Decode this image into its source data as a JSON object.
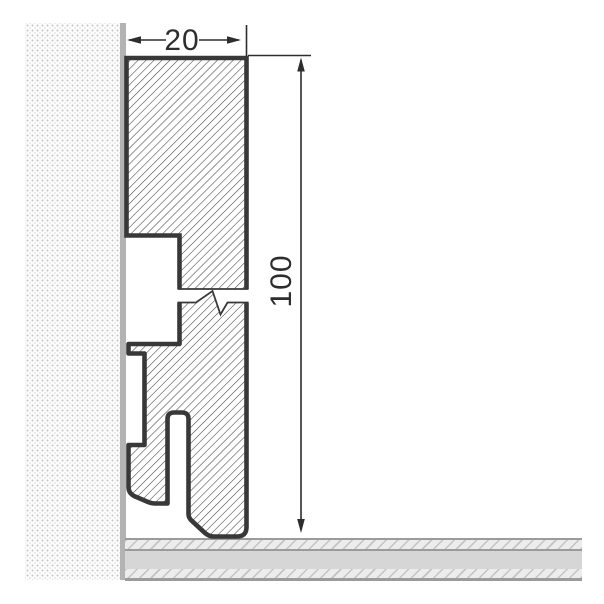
{
  "drawing": {
    "type": "skirting-board-cross-section",
    "dimensions": {
      "width": {
        "value": "20"
      },
      "height": {
        "value": "100"
      }
    }
  },
  "colors": {
    "background": "#ffffff",
    "profile_outline": "#383838",
    "profile_hatch_line": "#3f3f3f",
    "wall_edge": "#b3b3b3",
    "wall_dot": "#c8c8c8",
    "floor_line": "#9b9b9b",
    "floor_solid": "#d6d6d6",
    "floor_hatch_bg": "#ececec",
    "floor_hatch_line": "#c3c3c3",
    "dimension": "#2d2d2d"
  }
}
